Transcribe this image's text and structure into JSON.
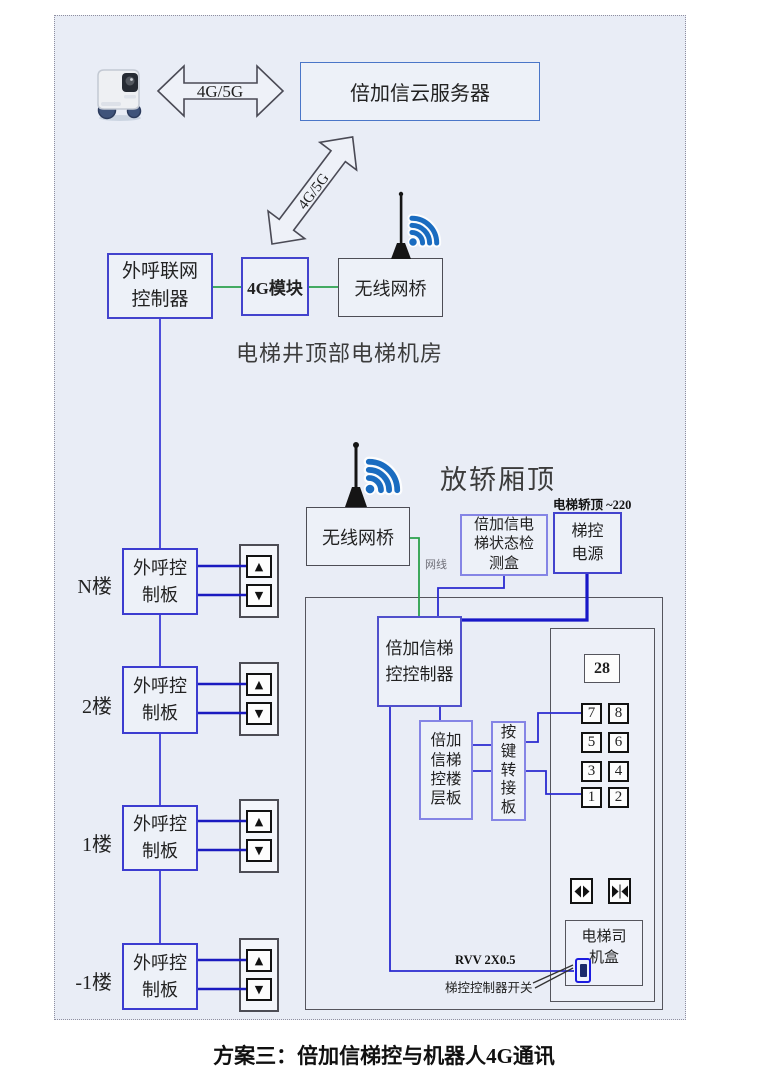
{
  "colors": {
    "background": "#e9edf6",
    "line_blue": "#2323cc",
    "line_green": "#2ba14c",
    "box_blue_border": "#4343cd",
    "box_lightblue_border": "#8585e5",
    "box_gray_border": "#4d4d55",
    "wifi_blue": "#1a6cc0",
    "switch_blue": "#1c1ce0"
  },
  "icons": {
    "up_arrow": "▲",
    "down_arrow": "▼"
  },
  "top": {
    "link_label": "4G/5G",
    "cloud_server": "倍加信云服务器",
    "diagonal_link_label": "4G/5G"
  },
  "machine_room": {
    "caption": "电梯井顶部电梯机房",
    "outcall_gateway": "外呼联网控制器",
    "module_4g": "4G模块",
    "wireless_bridge": "无线网桥"
  },
  "car_top": {
    "caption": "放轿厢顶",
    "wireless_bridge": "无线网桥",
    "power_note": "电梯轿顶 ~220",
    "status_box": "倍加信电梯状态检测盒",
    "elevator_power": "梯控电源",
    "cable_label": "网线"
  },
  "car": {
    "controller": "倍加信梯控控制器",
    "floor_board": "倍加信梯控楼层板",
    "key_adapter": "按键转接板",
    "display": "28",
    "keys": [
      "7",
      "8",
      "5",
      "6",
      "3",
      "4",
      "1",
      "2"
    ],
    "driver_box": "电梯司机盒",
    "rvv_label": "RVV 2X0.5",
    "switch_label": "梯控控制器开关"
  },
  "floors": [
    {
      "label": "N楼",
      "board": "外呼控制板"
    },
    {
      "label": "2楼",
      "board": "外呼控制板"
    },
    {
      "label": "1楼",
      "board": "外呼控制板"
    },
    {
      "label": "-1楼",
      "board": "外呼控制板"
    }
  ],
  "caption": "方案三：倍加信梯控与机器人4G通讯"
}
